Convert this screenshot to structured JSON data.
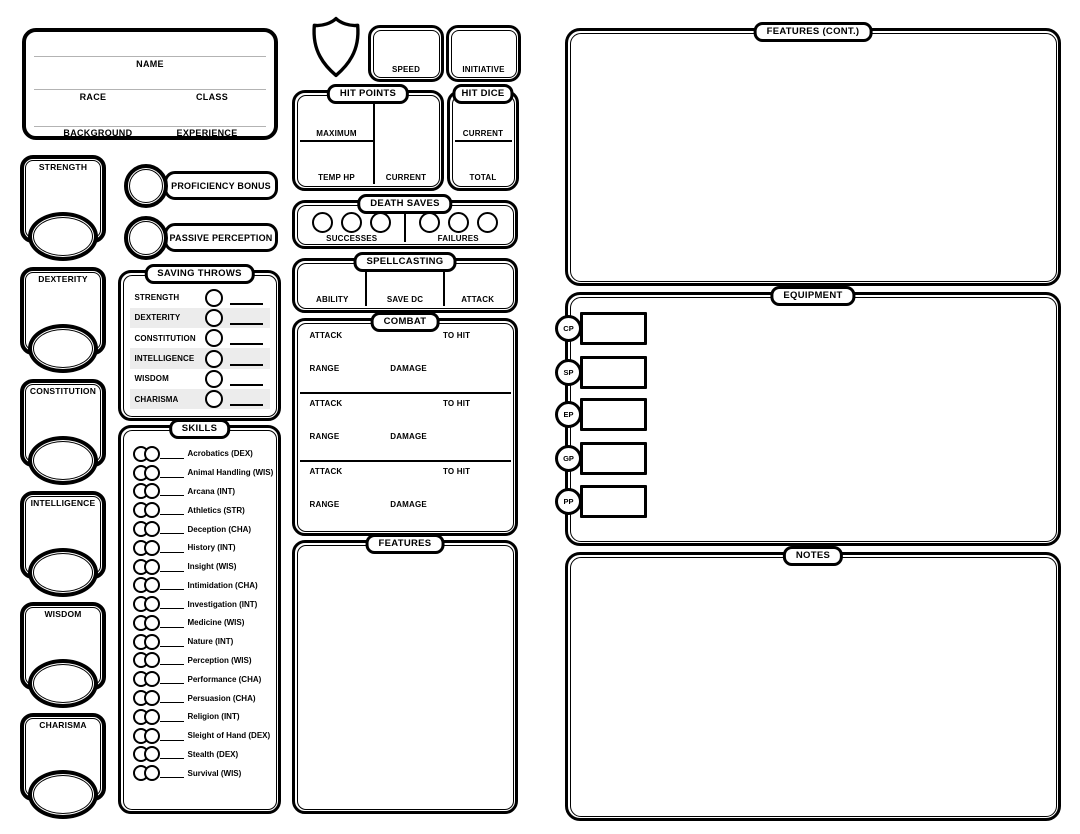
{
  "page": {
    "background": "#ffffff",
    "ink": "#000000",
    "alt_row_color": "#ececec"
  },
  "header": {
    "name_label": "NAME",
    "race_label": "RACE",
    "class_label": "CLASS",
    "background_label": "BACKGROUND",
    "experience_label": "EXPERIENCE"
  },
  "abilities": [
    {
      "label": "STRENGTH"
    },
    {
      "label": "DEXTERITY"
    },
    {
      "label": "CONSTITUTION"
    },
    {
      "label": "INTELLIGENCE"
    },
    {
      "label": "WISDOM"
    },
    {
      "label": "CHARISMA"
    }
  ],
  "proficiency": {
    "bonus_label": "PROFICIENCY BONUS",
    "passive_label": "PASSIVE PERCEPTION"
  },
  "saving_throws": {
    "title": "SAVING THROWS",
    "rows": [
      "STRENGTH",
      "DEXTERITY",
      "CONSTITUTION",
      "INTELLIGENCE",
      "WISDOM",
      "CHARISMA"
    ]
  },
  "skills": {
    "title": "SKILLS",
    "rows": [
      "Acrobatics (DEX)",
      "Animal Handling (WIS)",
      "Arcana (INT)",
      "Athletics (STR)",
      "Deception (CHA)",
      "History (INT)",
      "Insight (WIS)",
      "Intimidation (CHA)",
      "Investigation (INT)",
      "Medicine (WIS)",
      "Nature (INT)",
      "Perception (WIS)",
      "Performance (CHA)",
      "Persuasion (CHA)",
      "Religion (INT)",
      "Sleight of Hand (DEX)",
      "Stealth (DEX)",
      "Survival (WIS)"
    ]
  },
  "speed": {
    "label": "SPEED"
  },
  "initiative": {
    "label": "INITIATIVE"
  },
  "hit_points": {
    "title": "HIT POINTS",
    "maximum_label": "MAXIMUM",
    "temp_label": "TEMP HP",
    "current_label": "CURRENT"
  },
  "hit_dice": {
    "title": "HIT DICE",
    "current_label": "CURRENT",
    "total_label": "TOTAL"
  },
  "death_saves": {
    "title": "DEATH SAVES",
    "successes_label": "SUCCESSES",
    "failures_label": "FAILURES"
  },
  "spellcasting": {
    "title": "SPELLCASTING",
    "ability_label": "ABILITY",
    "save_dc_label": "SAVE DC",
    "attack_label": "ATTACK"
  },
  "combat": {
    "title": "COMBAT",
    "attack_label": "ATTACK",
    "to_hit_label": "TO HIT",
    "range_label": "RANGE",
    "damage_label": "DAMAGE"
  },
  "features": {
    "title": "FEATURES"
  },
  "features_cont": {
    "title": "FEATURES (CONT.)"
  },
  "equipment": {
    "title": "EQUIPMENT",
    "currencies": [
      "CP",
      "SP",
      "EP",
      "GP",
      "PP"
    ]
  },
  "notes": {
    "title": "NOTES"
  }
}
